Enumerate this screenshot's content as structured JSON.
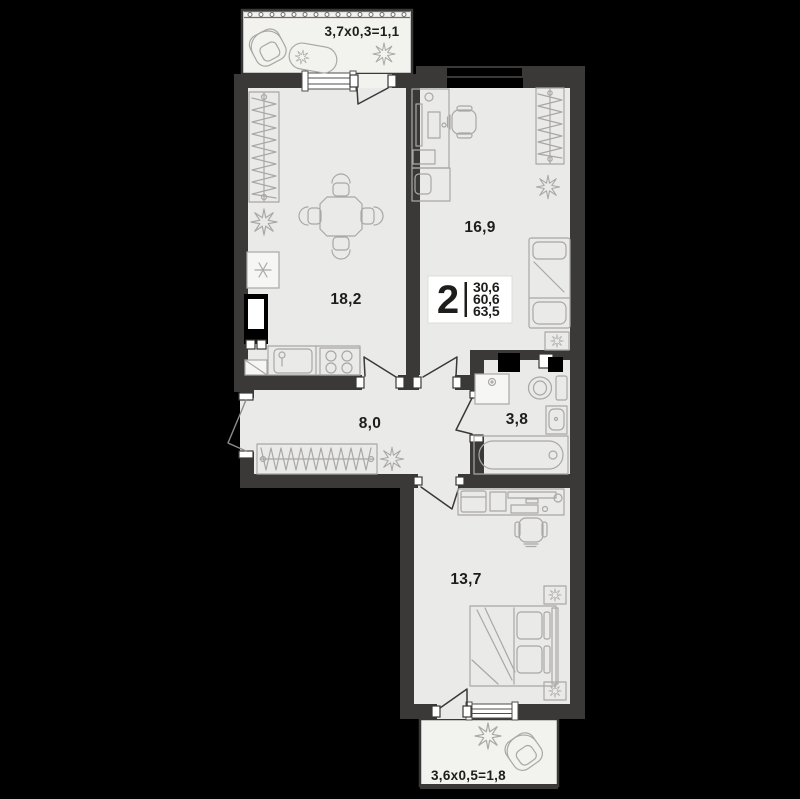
{
  "colors": {
    "background": "#000000",
    "wall": "#3a3937",
    "floor": "#eaeae8",
    "balcony_floor": "#f2f2ef",
    "furniture_line": "#a9a8a6",
    "text": "#1d1d1b",
    "badge_background": "#ffffff"
  },
  "badge": {
    "room_count": "2",
    "values": [
      "30,6",
      "60,6",
      "63,5"
    ]
  },
  "rooms": {
    "balcony_top": {
      "label": "3,7х0,3=1,1"
    },
    "kitchen_living": {
      "label": "18,2"
    },
    "room_top": {
      "label": "16,9"
    },
    "hallway": {
      "label": "8,0"
    },
    "bathroom": {
      "label": "3,8"
    },
    "room_bottom": {
      "label": "13,7"
    },
    "balcony_bottom": {
      "label": "3,6х0,5=1,8"
    }
  },
  "icons": {
    "plant-icon": "eight-point star flower",
    "armchair-icon": "rounded square with back arc",
    "chaise-icon": "rotated capsule",
    "wardrobe-icon": "rect with zigzag hangers",
    "fridge-icon": "box with snowflake",
    "stove-icon": "four burner circles",
    "kitchen-sink-icon": "rounded basin with faucet",
    "dining-table-icon": "octagon with four chairs",
    "desk-icon": "desk with monitor and keyboard",
    "office-chair-icon": "chair with armrests",
    "bed-icon": "bed with pillows and blanket",
    "nightstand-icon": "small box with plant",
    "washing-machine-icon": "box with water drop",
    "toilet-icon": "bowl ellipse with tank",
    "bathtub-icon": "capsule tub with drain",
    "vent-shaft-icon": "black duct box",
    "door-icon": "leaf swing triangle",
    "window-icon": "double-line glazing with caps",
    "railing-icon": "dotted balcony rail"
  }
}
